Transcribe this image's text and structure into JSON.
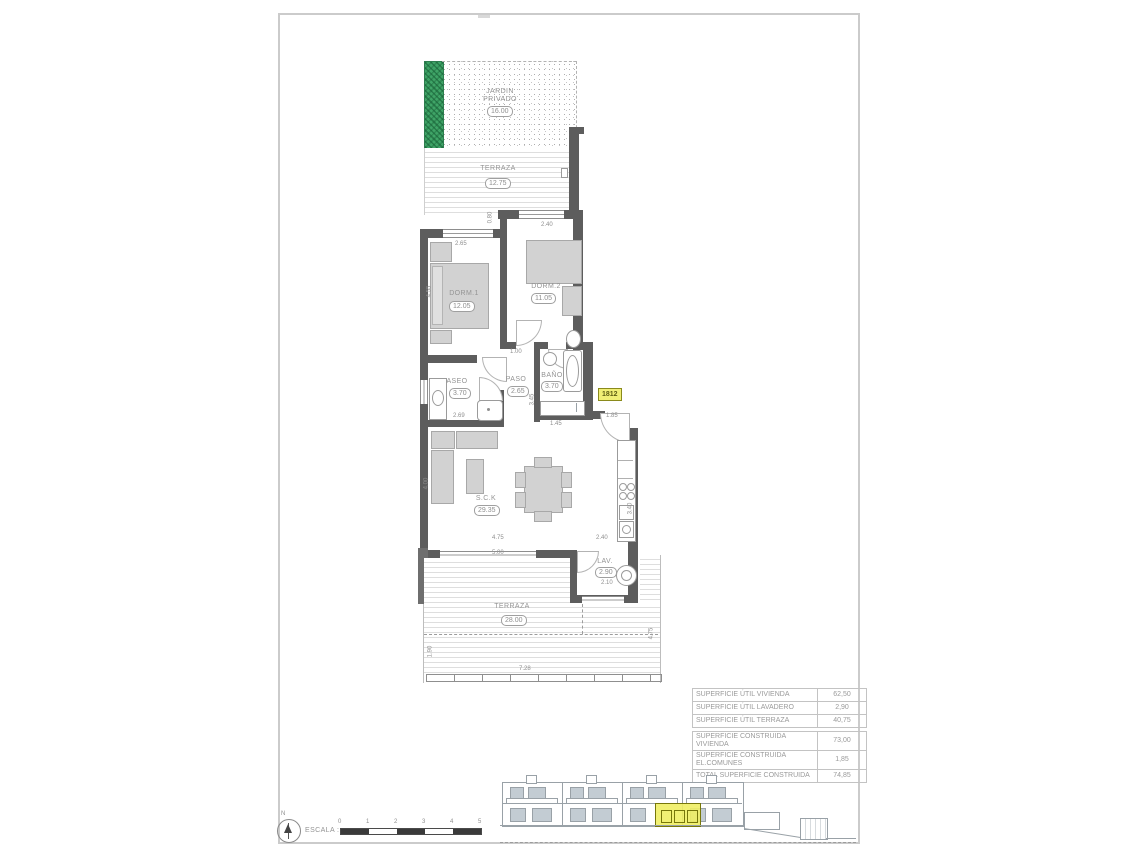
{
  "meta": {
    "unit_badge": "1812"
  },
  "plan": {
    "garden": {
      "label1": "JARDIN",
      "label2": "PRIVADO",
      "area": "16.00"
    },
    "terrace_top": {
      "label": "TERRAZA",
      "area": "12.75"
    },
    "terrace_bottom": {
      "label": "TERRAZA",
      "area": "28.00"
    },
    "rooms": [
      {
        "label": "DORM.1",
        "area": "12.05"
      },
      {
        "label": "DORM.2",
        "area": "11.05"
      },
      {
        "label": "ASEO",
        "area": "3.70"
      },
      {
        "label": "PASO",
        "area": "2.65"
      },
      {
        "label": "BAÑO",
        "area": "3.70"
      },
      {
        "label": "S.C.K",
        "area": "29.35"
      },
      {
        "label": "LAV.",
        "area": "2.90"
      }
    ],
    "dims": {
      "d265_top": "2.65",
      "d240_top": "2.40",
      "d455_left": "4.55",
      "d080_step": "0.80",
      "d100_hall": "1.00",
      "d269_aseo": "2.69",
      "d345_paso": "3.45",
      "d145_closet": "1.45",
      "d185_entry": "1.85",
      "d400_living": "4.00",
      "d475_living": "4.75",
      "d500_living": "5.00",
      "d240_lav": "2.40",
      "d340_kitchen": "3.40",
      "d210_lav": "2.10",
      "d190_terr": "1.90",
      "d475_terr": "4.75",
      "d728_terr": "7.28"
    }
  },
  "areas_table": {
    "util": [
      {
        "label": "SUPERFICIE ÚTIL VIVIENDA",
        "value": "62,50"
      },
      {
        "label": "SUPERFICIE ÚTIL LAVADERO",
        "value": "2,90"
      },
      {
        "label": "SUPERFICIE ÚTIL TERRAZA",
        "value": "40,75"
      }
    ],
    "construida": [
      {
        "label": "SUPERFICIE CONSTRUIDA VIVIENDA",
        "value": "73,00"
      },
      {
        "label": "SUPERFICIE CONSTRUIDA EL.COMUNES",
        "value": "1,85"
      },
      {
        "label": "TOTAL SUPERFICIE CONSTRUIDA",
        "value": "74,85"
      }
    ]
  },
  "scale": {
    "label": "ESCALA :",
    "north": "N",
    "ticks": [
      "0",
      "1",
      "2",
      "3",
      "4",
      "5"
    ]
  },
  "colors": {
    "wall": "#5d5d5d",
    "highlight": "#f0ee75",
    "garden_green": "#3fa467",
    "text": "#8f8f8f"
  }
}
